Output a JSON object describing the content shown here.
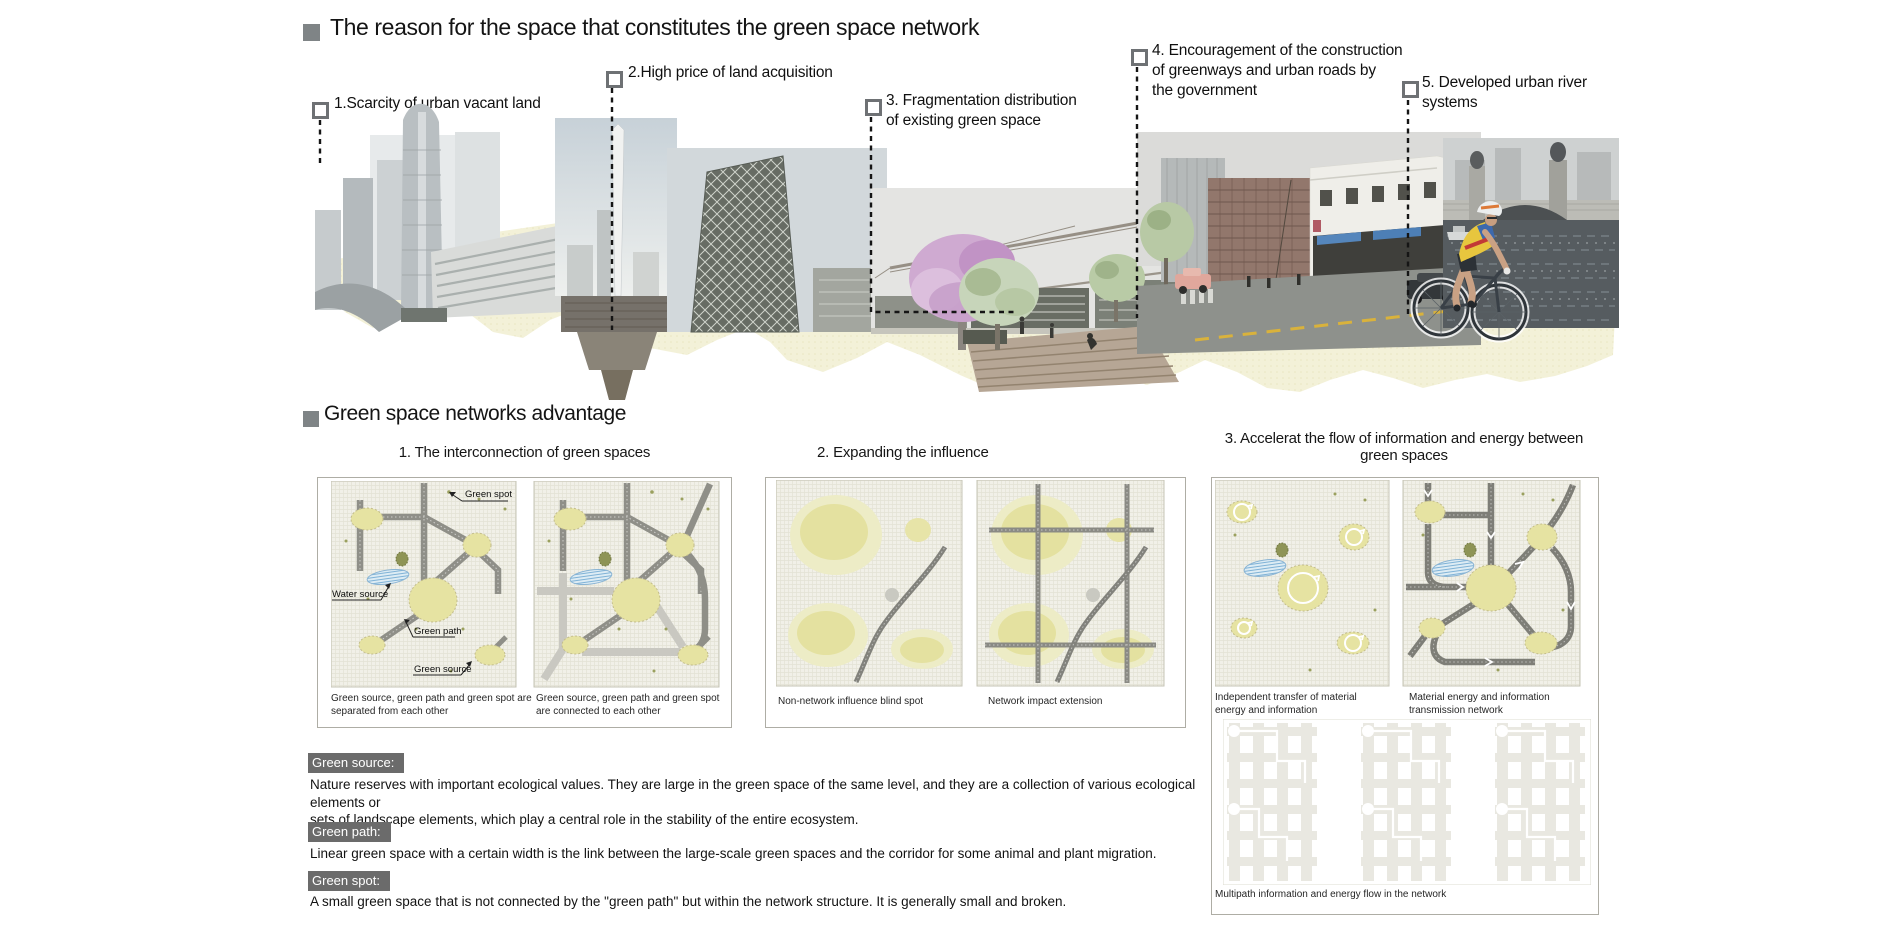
{
  "section1": {
    "title": "The reason for the space that constitutes the green space network",
    "callouts": [
      {
        "label": "1.Scarcity of urban vacant land"
      },
      {
        "label": "2.High price of land acquisition"
      },
      {
        "label": "3. Fragmentation distribution\nof existing green space"
      },
      {
        "label": "4. Encouragement of the construction\nof greenways and urban roads by\n the government"
      },
      {
        "label": "5. Developed urban river\nsystems"
      }
    ]
  },
  "section2": {
    "title": "Green space networks advantage",
    "panels": [
      {
        "heading": "1. The interconnection of green spaces",
        "diagram_labels": {
          "green_spot": "Green spot",
          "water_source": "Water source",
          "green_path": "Green path",
          "green_source": "Green source"
        },
        "captions": [
          "Green source, green path and green spot are\nseparated from each other",
          "Green source, green path and green spot\n are connected to each other"
        ]
      },
      {
        "heading": "2. Expanding the influence",
        "captions": [
          "Non-network influence blind spot",
          "Network impact extension"
        ]
      },
      {
        "heading": "3. Accelerat the flow of information and energy between\ngreen spaces",
        "captions": [
          "Independent transfer of material\nenergy and information",
          "Material energy and information\n transmission network",
          "Multipath information and energy flow in the network"
        ]
      }
    ]
  },
  "definitions": [
    {
      "term": "Green source:",
      "text": "Nature reserves with important ecological values. They are large in the green space of the same level, and they are a collection of various ecological elements or\n sets of landscape elements, which play a central role in the stability of the entire ecosystem."
    },
    {
      "term": "Green path:",
      "text": " Linear green space with a certain width is the link between the large-scale green spaces and the corridor for some animal and plant migration."
    },
    {
      "term": "Green spot:",
      "text": "A small green space that is not connected by the \"green path\" but within the network structure. It is generally small and broken."
    }
  ],
  "colors": {
    "label_box_gray": "#6b6b6b",
    "bullet_gray": "#7f8486",
    "green_blob": "#e6e3a2",
    "water_blue": "#7fb2d6",
    "road_dark": "#8d8d86",
    "road_light": "#c9c8c1",
    "backdrop_cream": "#f3f1d8"
  }
}
